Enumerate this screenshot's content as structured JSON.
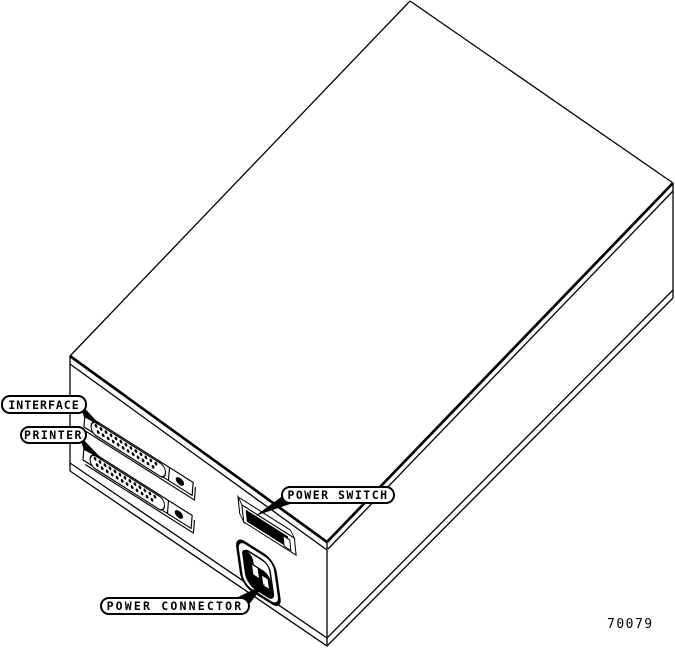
{
  "figure": {
    "number": "70079",
    "colors": {
      "ink": "#000000",
      "paper": "#ffffff"
    },
    "callouts": [
      {
        "id": "interface",
        "text": "INTERFACE"
      },
      {
        "id": "printer",
        "text": "PRINTER"
      },
      {
        "id": "power_switch",
        "text": "POWER SWITCH"
      },
      {
        "id": "power_connector",
        "text": "POWER CONNECTOR"
      }
    ],
    "connector_pins": {
      "rows": [
        13,
        12
      ]
    }
  }
}
